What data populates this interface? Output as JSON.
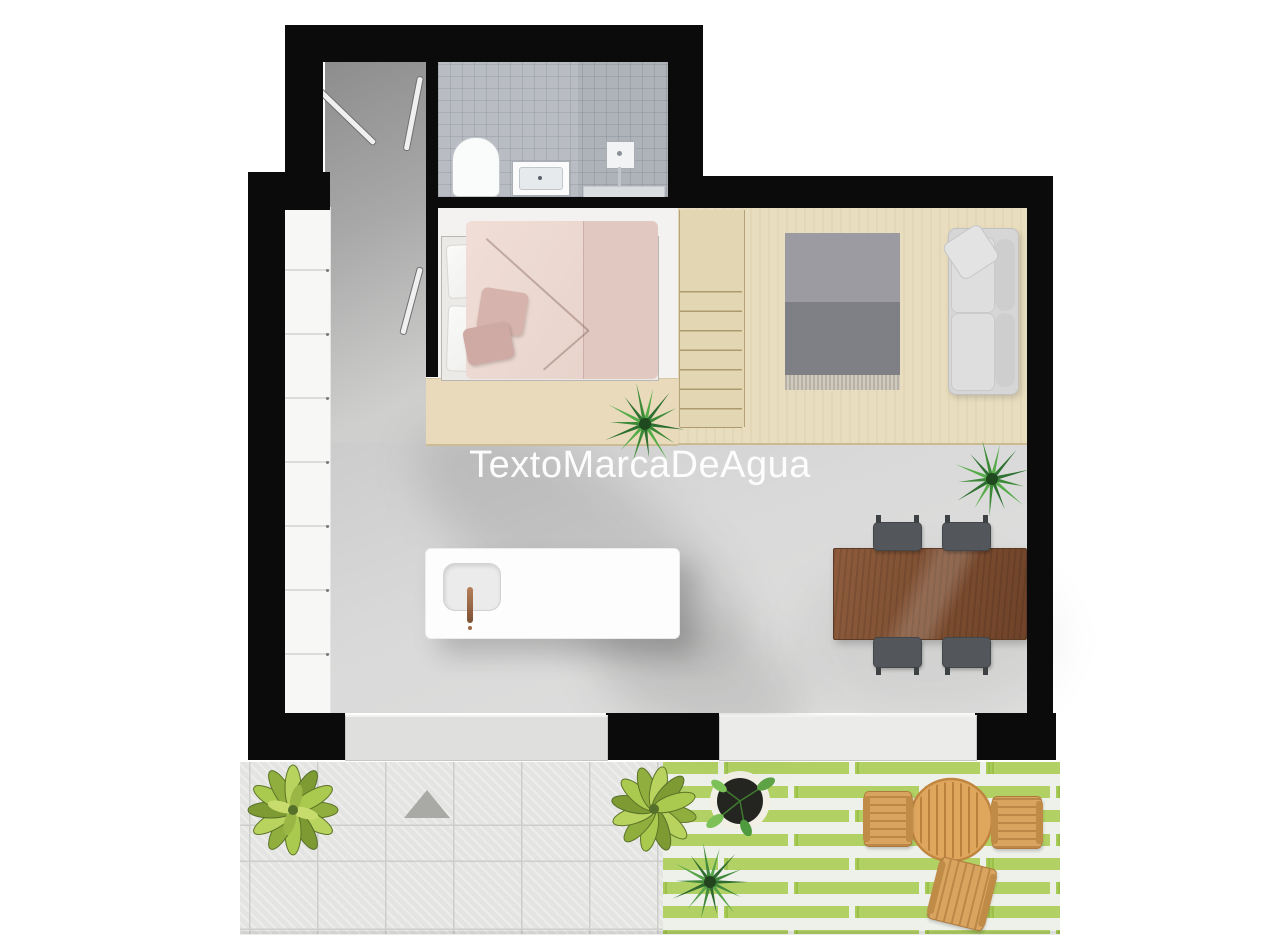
{
  "watermark": {
    "text": "TextoMarcaDeAgua",
    "color": "#ffffff"
  },
  "palette": {
    "wall": "#0b0b0b",
    "interior_floor": "#d9d9d9",
    "corridor": "#a8a8a8",
    "platform_wood": "#e8ddbe",
    "bedding_pink": "#ead6ce",
    "throw_pillow_pink": "#d6b3ac",
    "rug_gray": "#8e8e94",
    "sofa_gray": "#d6d6d6",
    "dining_table_wood": "#8a573a",
    "dining_chair": "#53575b",
    "island_white": "#fdfdfd",
    "faucet_copper": "#b5805a",
    "bathroom_tile": "#b9bdc3",
    "terrace_tile": "#e4e5e2",
    "lawn_green": "#a9cb58",
    "outdoor_wood": "#d9a45f",
    "plant_green": "#418a3b"
  },
  "rooms": {
    "entry": {
      "features": [
        "stair-rails",
        "wardrobe-cabinets"
      ]
    },
    "bathroom": {
      "fixtures": [
        "toilet",
        "sink-vanity",
        "shower-head",
        "shower-bench"
      ]
    },
    "bedroom": {
      "furniture": [
        "platform-bed",
        "white-pillows",
        "throw-pillows"
      ]
    },
    "living_loft": {
      "furniture": [
        "loft-stairs",
        "area-rug",
        "sofa",
        "potted-fern"
      ]
    },
    "kitchen": {
      "furniture": [
        "island-counter",
        "sink",
        "faucet"
      ]
    },
    "dining": {
      "furniture": [
        "wood-table",
        "chairs"
      ],
      "chair_count": 4
    },
    "terrace": {
      "features": [
        "stone-tiles",
        "striped-lawn",
        "shrubs",
        "direction-triangle",
        "potted-plant",
        "fern",
        "round-table",
        "outdoor-chairs"
      ],
      "outdoor_chair_count": 3
    }
  }
}
